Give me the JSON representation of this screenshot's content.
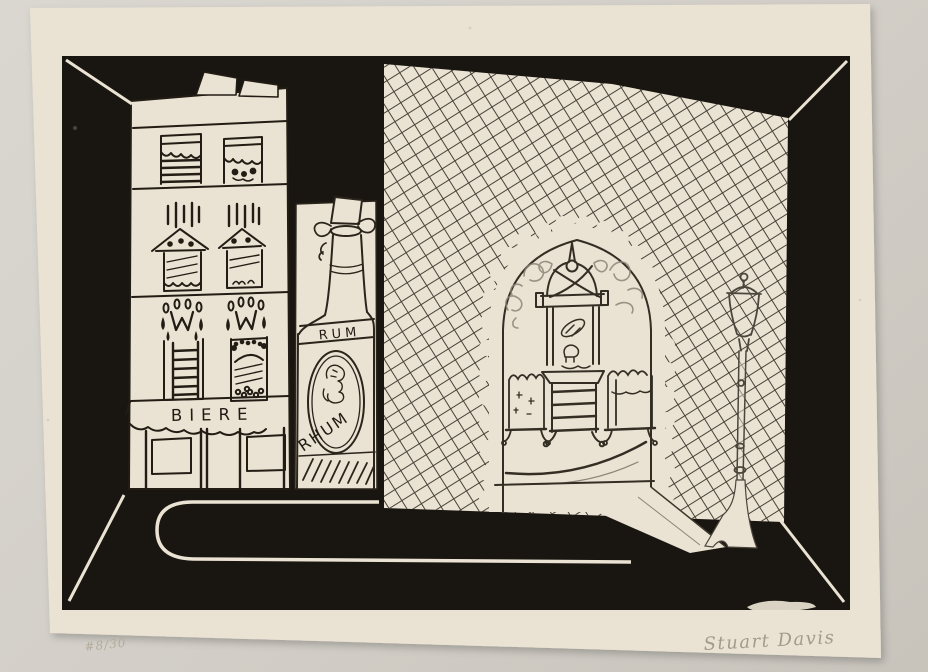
{
  "artwork": {
    "building_sign": "BIERE",
    "bottle_neck_label": "RUM",
    "bottle_body_label": "RHUM",
    "edition_inscription": "#8/30",
    "signature": "Stuart Davis",
    "colors": {
      "photo_background": "#d2cec7",
      "paper": "#eae3d3",
      "plate_ink": "#191510",
      "hatch_ink": "#3a342b",
      "pencil": "#a59d90"
    }
  }
}
